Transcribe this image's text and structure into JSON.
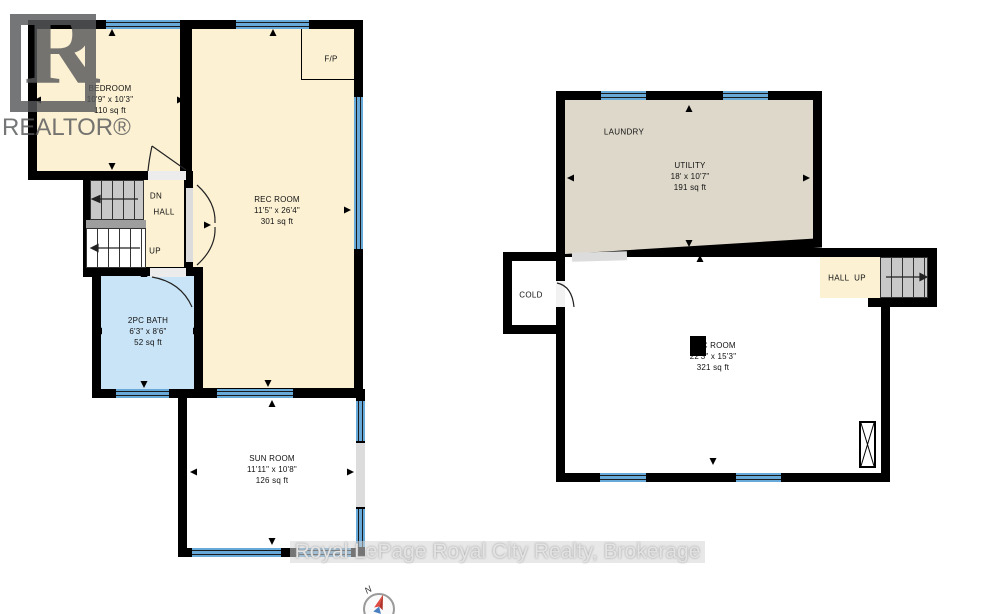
{
  "watermarks": {
    "realtor_logo_letter": "R",
    "realtor_logo_text": "REALTOR®",
    "brokerage_text": "Royal LePage Royal City Realty, Brokerage"
  },
  "compass": {
    "north_label": "N"
  },
  "plan_left": {
    "bedroom": {
      "name": "BEDROOM",
      "dims": "10'9\" x 10'3\"",
      "area": "110 sq ft"
    },
    "rec_room": {
      "name": "REC ROOM",
      "dims": "11'5\" x 26'4\"",
      "area": "301 sq ft"
    },
    "fireplace_label": "F/P",
    "stairs_down_label": "DN",
    "hall_label": "HALL",
    "stairs_up_label": "UP",
    "bath": {
      "name": "2PC BATH",
      "dims": "6'3\" x 8'6\"",
      "area": "52 sq ft"
    },
    "sun_room": {
      "name": "SUN ROOM",
      "dims": "11'11\" x 10'8\"",
      "area": "126 sq ft"
    }
  },
  "plan_right": {
    "laundry_label": "LAUNDRY",
    "utility": {
      "name": "UTILITY",
      "dims": "18' x 10'7\"",
      "area": "191 sq ft"
    },
    "cold_label": "COLD",
    "hall_up_label": "HALL  UP",
    "rec_room": {
      "name": "REC ROOM",
      "dims": "22'3\" x 15'3\"",
      "area": "321 sq ft"
    }
  },
  "colors": {
    "wall": "#000000",
    "room_cream": "#fcf1d3",
    "room_blue": "#c9e4f6",
    "room_tan": "#ded8ca",
    "window_blue": "#67a9d9",
    "logo_gray": "#57585a"
  }
}
